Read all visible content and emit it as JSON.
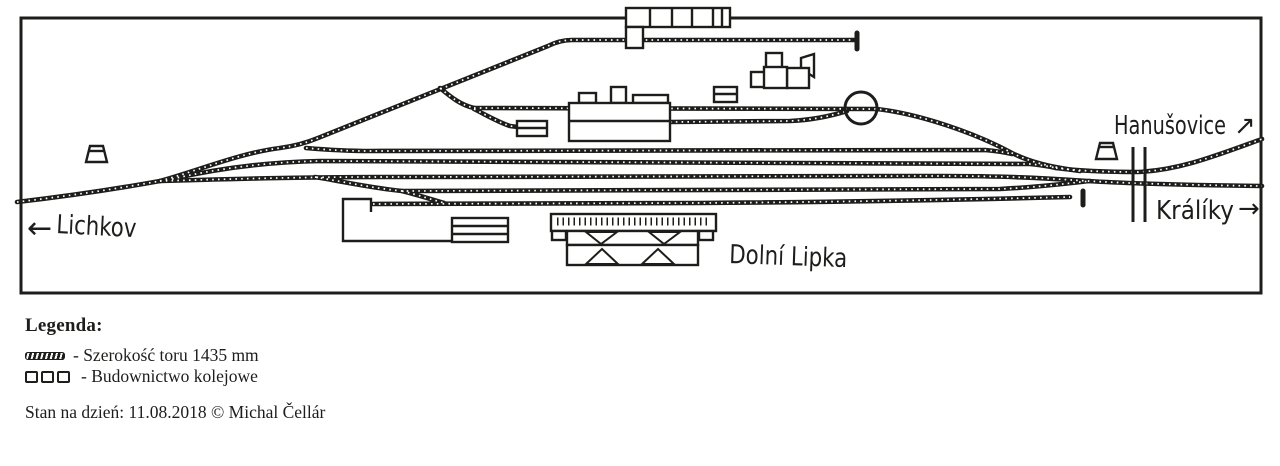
{
  "colors": {
    "ink": "#1d1d1b",
    "paper": "#ffffff"
  },
  "diagram": {
    "station_label": "Dolní Lipka",
    "west": {
      "arrow": "←",
      "label": "Lichkov"
    },
    "northeast": {
      "label": "Hanušovice",
      "arrow": "↗"
    },
    "east": {
      "label": "Králíky",
      "arrow": "→"
    }
  },
  "legend": {
    "heading": "Legenda:",
    "items": [
      {
        "icon": "track-gauge-symbol",
        "label": "- Szerokość toru 1435 mm"
      },
      {
        "icon": "railway-buildings-symbol",
        "label": "- Budownictwo kolejowe"
      }
    ],
    "status_line": "Stan na dzień: 11.08.2018 © Michal Čellár"
  }
}
